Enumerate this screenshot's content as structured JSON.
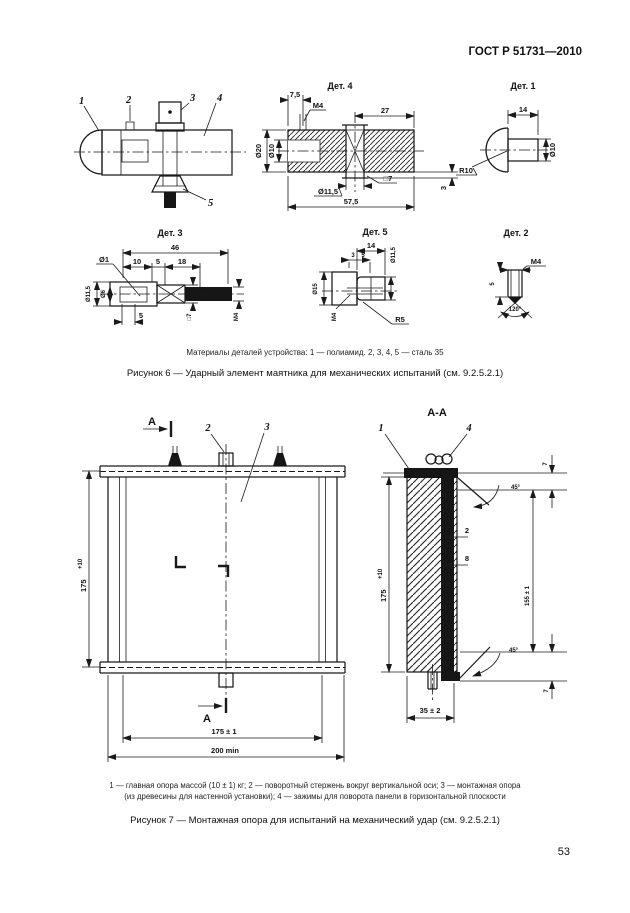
{
  "page": {
    "header": "ГОСТ Р 51731—2010",
    "number": "53"
  },
  "figure6": {
    "materials_note": "Материалы деталей устройства: 1 — полиамид.  2, 3, 4, 5 — сталь 35",
    "caption": "Рисунок 6 — Ударный элемент маятника для механических испытаний (см. 9.2.5.2.1)",
    "assembly": {
      "p1": "1",
      "p2": "2",
      "p3": "3",
      "p4": "4",
      "p5": "5"
    },
    "det1": {
      "title": "Дет. 1",
      "len": "14",
      "radius": "R10",
      "dia": "Ø10"
    },
    "det2": {
      "title": "Дет. 2",
      "thread": "M4",
      "len": "5",
      "angle": "120°"
    },
    "det3": {
      "title": "Дет. 3",
      "total": "46",
      "s10": "10",
      "s5": "5",
      "s18": "18",
      "hole": "Ø1",
      "dia_out": "Ø11,5",
      "dia_in": "Ø6",
      "square": "□7",
      "thread": "M4",
      "off5": "5"
    },
    "det4": {
      "title": "Дет. 4",
      "s75": "7,5",
      "thread": "M4",
      "s27": "27",
      "dia20": "Ø20",
      "dia10": "Ø10",
      "dia115": "Ø11,5",
      "square": "□7",
      "total": "57,5",
      "s3": "3"
    },
    "det5": {
      "title": "Дет. 5",
      "len": "14",
      "s3": "3",
      "s5": "5",
      "dia15": "Ø15",
      "dia115": "Ø11,5",
      "thread": "M4",
      "radius": "R5"
    }
  },
  "figure7": {
    "legend_line1": "1 — главная опора массой (10 ± 1) кг; 2 — поворотный стержень вокруг вертикальной оси; 3 — монтажная опора",
    "legend_line2": "(из древесины для настенной установки); 4 — зажимы для поворота панели в горизонтальной плоскости",
    "caption": "Рисунок 7 — Монтажная опора для испытаний на механический удар (см. 9.2.5.2.1)",
    "front": {
      "section": "А",
      "p2": "2",
      "p3": "3",
      "h175": "175",
      "tol": "+10",
      "w175": "175 ± 1",
      "w200": "200 min"
    },
    "section": {
      "title": "А-А",
      "p1": "1",
      "p4": "4",
      "t7": "7",
      "a45": "45°",
      "t2": "2",
      "t8": "8",
      "h155": "155 ± 1",
      "h175": "175",
      "tol": "+10",
      "b45": "45°",
      "b7": "7",
      "w35": "35 ± 2"
    }
  }
}
